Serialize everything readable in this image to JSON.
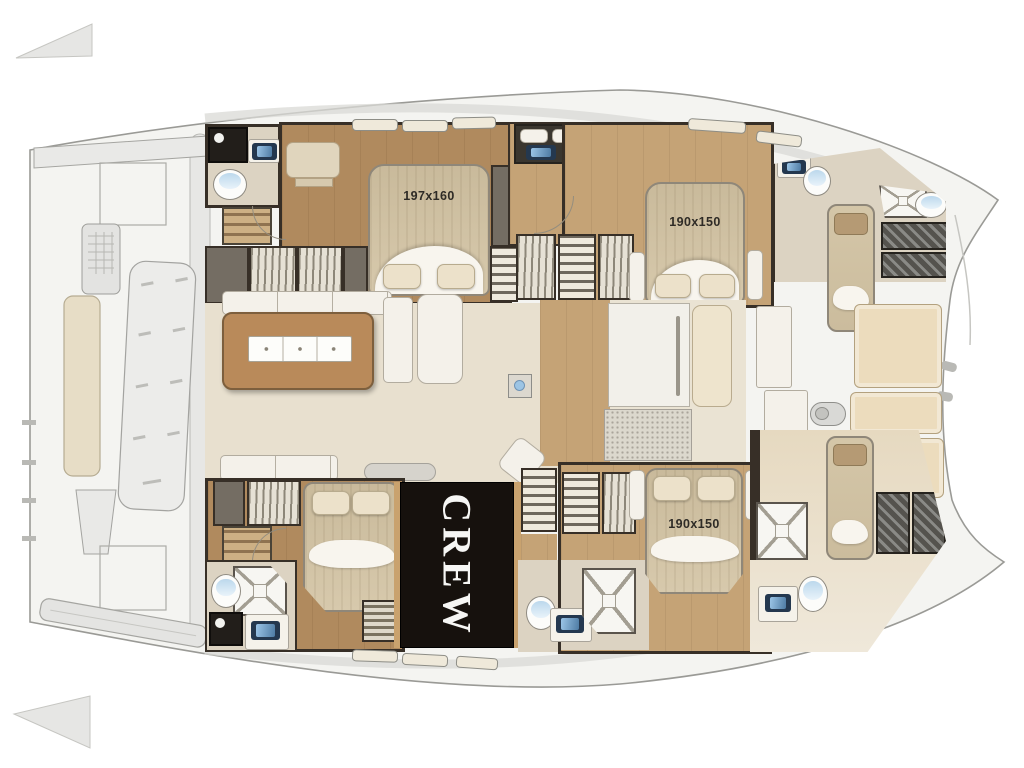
{
  "palette": {
    "hull_outline": "#9a9a96",
    "deck_gray": "#e9e9e7",
    "wall_dark": "#372f27",
    "wood_floor_aft": "#b08a5e",
    "wood_floor_fwd": "#c5a376",
    "saloon_floor": "#e8e0cf",
    "island_wood": "#b98a5a",
    "bed_tan": "#d2c3a5",
    "blanket_white": "#f8f5ee",
    "fixture_white": "#f4f1ea",
    "sink_navy": "#24384f",
    "sink_blue": "#9cc6e8",
    "crew_bg": "#16110d",
    "crew_text": "#f6f6f4",
    "label_text": "#2e2b26"
  },
  "plan": {
    "beds": {
      "master_label": "197x160",
      "vip_forward_label": "190x150",
      "vip_aft_label": "190x150"
    },
    "crew": {
      "label": "CREW"
    }
  }
}
